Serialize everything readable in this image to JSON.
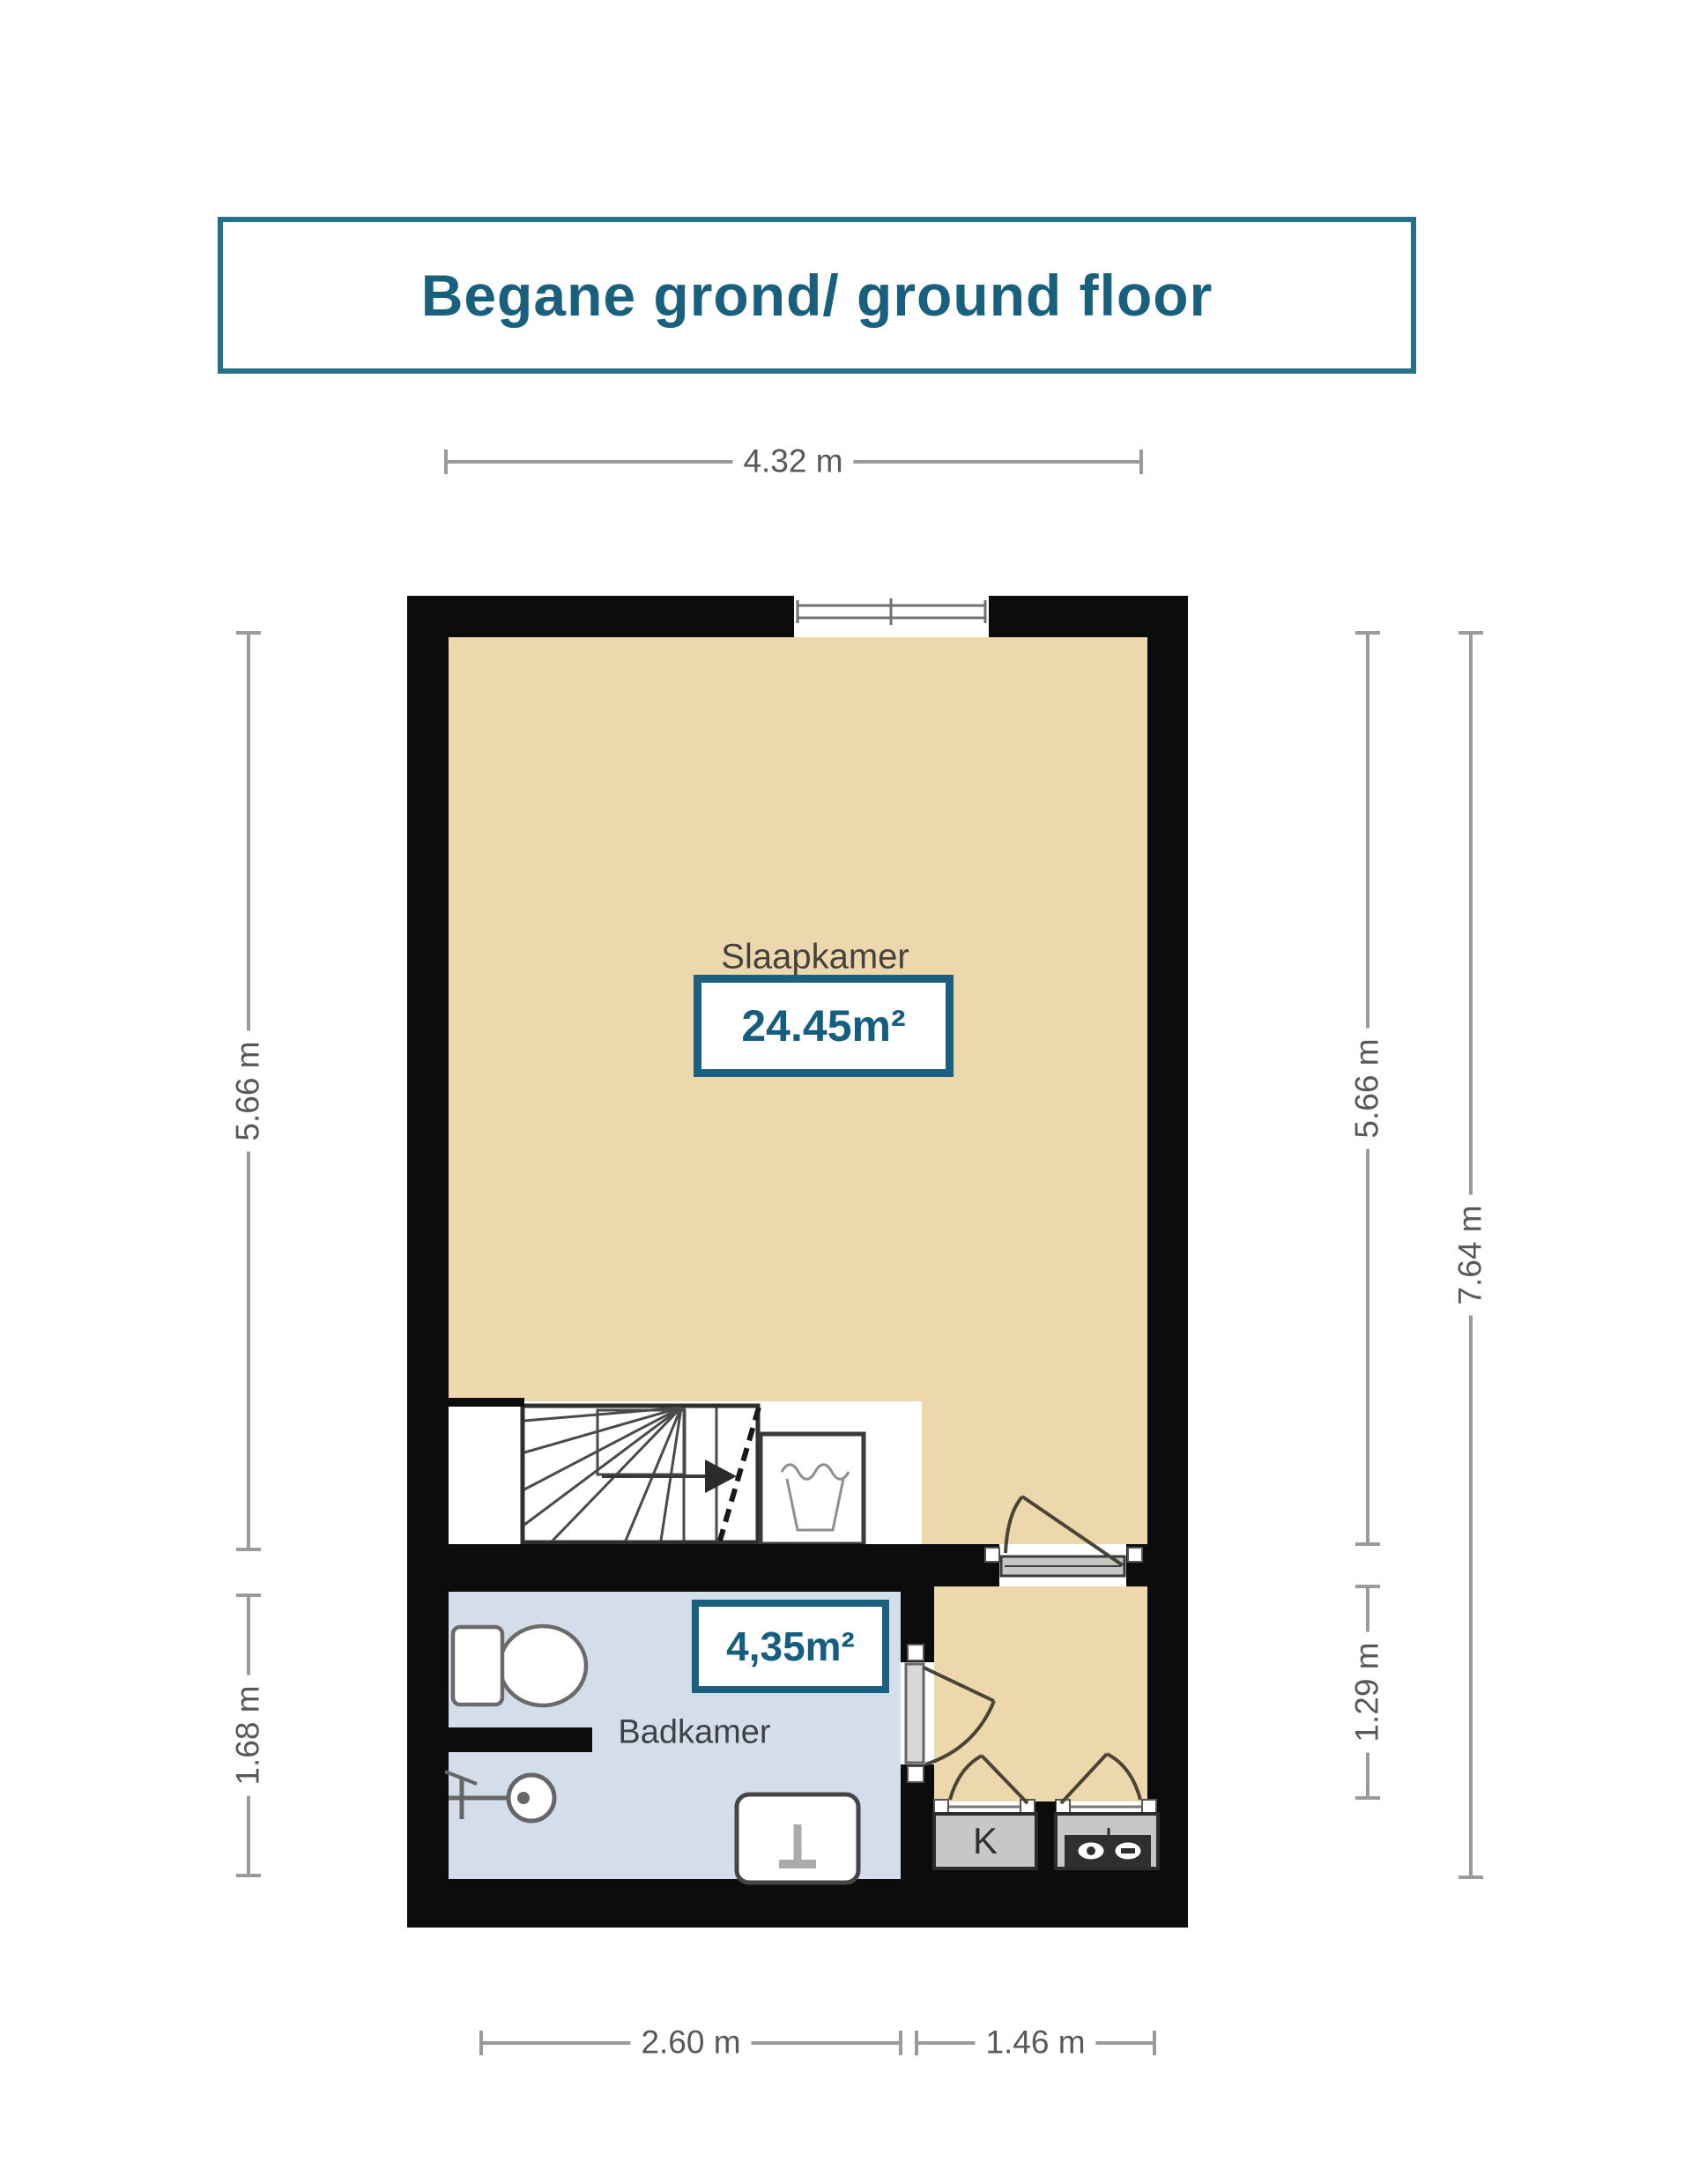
{
  "title": "Begane grond/ ground floor",
  "floor_plan": {
    "rooms": {
      "bedroom": {
        "label": "Slaapkamer",
        "area": "24.45m²"
      },
      "bathroom": {
        "label": "Badkamer",
        "area": "4,35m²"
      },
      "kitchen_unit": {
        "label": "K"
      }
    },
    "dimensions": {
      "top": "4.32 m",
      "left_upper": "5.66 m",
      "left_lower": "1.68 m",
      "right_upper": "5.66 m",
      "right_lower": "1.29 m",
      "right_overall": "7.64 m",
      "bottom_left": "2.60 m",
      "bottom_right": "1.46 m"
    },
    "icons": [
      "window-icon",
      "stairs-icon",
      "stairs-direction-arrow-icon",
      "washing-machine-icon",
      "toilet-icon",
      "shower-icon",
      "sink-icon",
      "kitchen-counter",
      "stove-icon",
      "door-swing-icon"
    ],
    "colors": {
      "accent_teal": "#1b607f",
      "wall_black": "#0c0c0c",
      "floor_beige": "#edd8ae",
      "floor_bathroom_blue": "#d4deeb",
      "dimension_gray": "#9a9a9a",
      "dimension_text": "#58585a",
      "unit_gray": "#c7c7c7"
    }
  }
}
